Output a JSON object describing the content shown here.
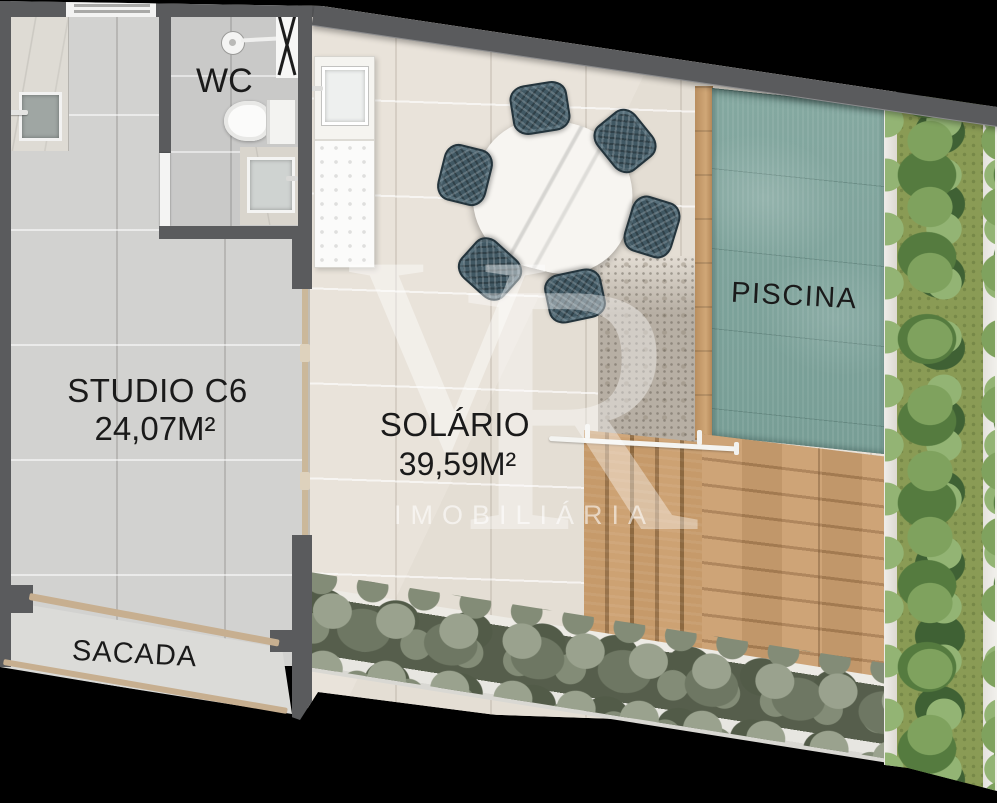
{
  "rooms": {
    "wc": {
      "label": "WC"
    },
    "studio": {
      "label": "STUDIO C6",
      "area": "24,07M²"
    },
    "solario": {
      "label": "SOLÁRIO",
      "area": "39,59M²"
    },
    "piscina": {
      "label": "PISCINA"
    },
    "sacada": {
      "label": "SACADA"
    }
  },
  "watermark": {
    "letter_v": "V",
    "letter_r": "R",
    "subtitle": "IMOBILIÁRIA"
  },
  "palette": {
    "background": "#000000",
    "wall": "#5a5b5d",
    "studio_floor": "#d2d2d0",
    "solario_floor": "#e8e2d9",
    "pool_water": "#7fa49d",
    "wood": "#c79a6b",
    "hedge_foliage": "#76806b",
    "planter_grass": "#8a9b55",
    "bush_green": "#6f9152",
    "railing_tan": "#c7af90",
    "label_text": "#1a1a1a"
  }
}
